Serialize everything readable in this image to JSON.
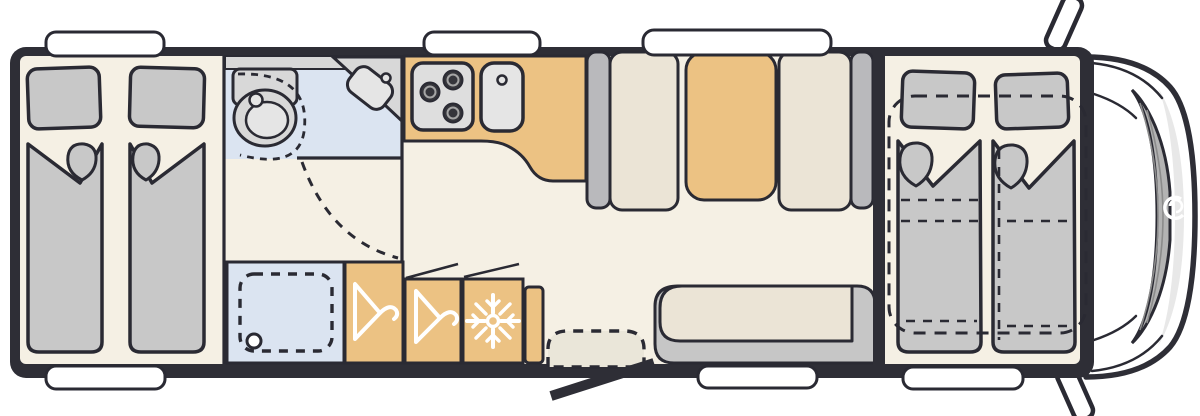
{
  "floorplan": {
    "type": "motorhome-top-view-floorplan",
    "colors": {
      "outline": "#2a2a33",
      "wall": "#2e2e36",
      "floor": "#f5f0e4",
      "floor-shade": "#eae6d9",
      "bedding": "#c8c8c8",
      "fixture": "#d8d8d8",
      "fixture-light": "#e5e5e5",
      "burner": "#35353b",
      "seat": "#ebe4d6",
      "seat-back": "#b9b9bc",
      "sofa": "#c6c6c6",
      "wood": "#ecc283",
      "wetroom": "#dbe4f1",
      "window": "#ffffff",
      "cab-shade": "#e8e8e8",
      "windshield": "#b3b3b3",
      "icon": "#ffffff"
    },
    "icons": {
      "wardrobe_left": "hanger-icon",
      "wardrobe_right": "hanger-icon",
      "fridge": "snowflake-icon",
      "cab_brand": "swirl-logo-icon"
    }
  }
}
